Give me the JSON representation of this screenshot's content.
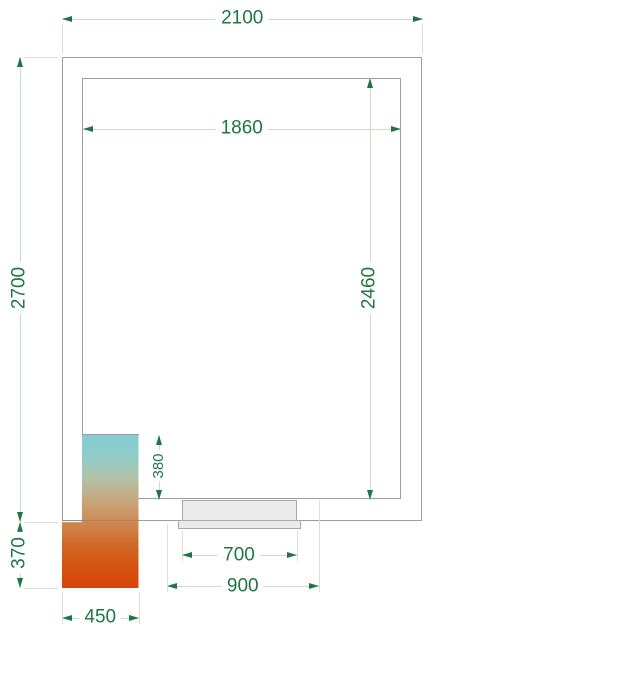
{
  "dimensions": {
    "outer_width": {
      "label": "2100"
    },
    "inner_width": {
      "label": "1860"
    },
    "outer_height": {
      "label": "2700"
    },
    "inner_height": {
      "label": "2460"
    },
    "unit_inside_depth": {
      "label": "380"
    },
    "unit_outside_depth": {
      "label": "370"
    },
    "unit_width": {
      "label": "450"
    },
    "door_leaf_width": {
      "label": "700"
    },
    "door_opening_width": {
      "label": "900"
    }
  },
  "colors": {
    "dimension_text_green": "#1e7743",
    "dimension_line": "#ccdccc",
    "wall_outline": "#9d9d9d",
    "door_fill": "#eaeaea",
    "unit_gradient": [
      "#84ccd3",
      "#8fccc9",
      "#b3c2a8",
      "#c6a87e",
      "#cd8a54",
      "#cf6a2a",
      "#d4540f",
      "#d8440a"
    ]
  }
}
